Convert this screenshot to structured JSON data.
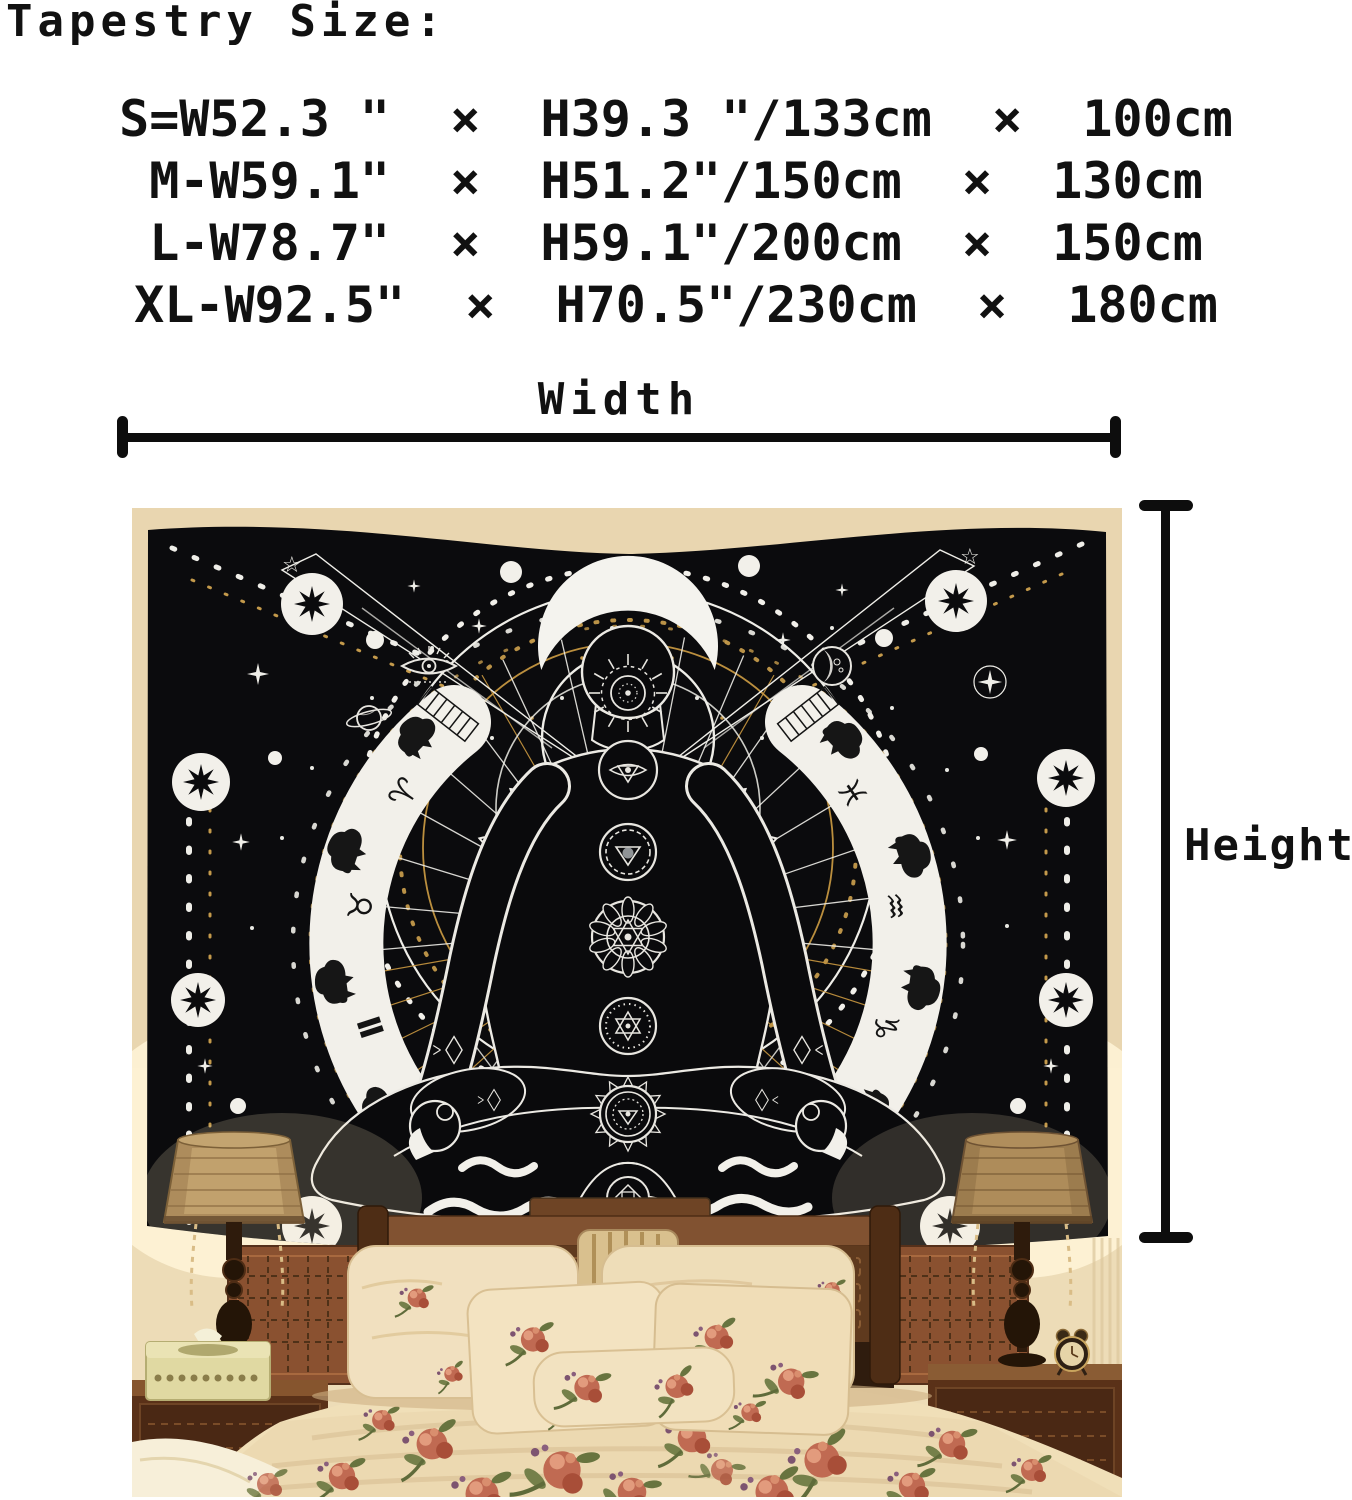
{
  "header": {
    "title": "Tapestry Size:"
  },
  "size_chart": {
    "rows": [
      {
        "size": "S",
        "text": "S=W52.3 \"  ×  H39.3 \"/133cm  ×  100cm"
      },
      {
        "size": "M",
        "text": "M-W59.1\"  ×  H51.2\"/150cm  ×  130cm"
      },
      {
        "size": "L",
        "text": "L-W78.7\"  ×  H59.1\"/200cm  ×  150cm"
      },
      {
        "size": "XL",
        "text": "XL-W92.5\"  ×  H70.5\"/230cm  ×  180cm"
      }
    ]
  },
  "dimension_labels": {
    "width": "Width",
    "height": "Height"
  },
  "photo": {
    "tapestry": {
      "zodiac_left": [
        "♈",
        "♉",
        "Ⅱ",
        "♋"
      ],
      "zodiac_right": [
        "♓",
        "♒",
        "♑",
        "♐"
      ],
      "star_outline": "☆"
    }
  },
  "colors": {
    "measure_line": "#0d0d0d",
    "tapestry_black": "#0b0b0d",
    "tapestry_white": "#efeee8",
    "accent_gold": "#c49a4b",
    "wall_beige": "#e9d6b0",
    "bedding_cream": "#f0dfb8"
  }
}
